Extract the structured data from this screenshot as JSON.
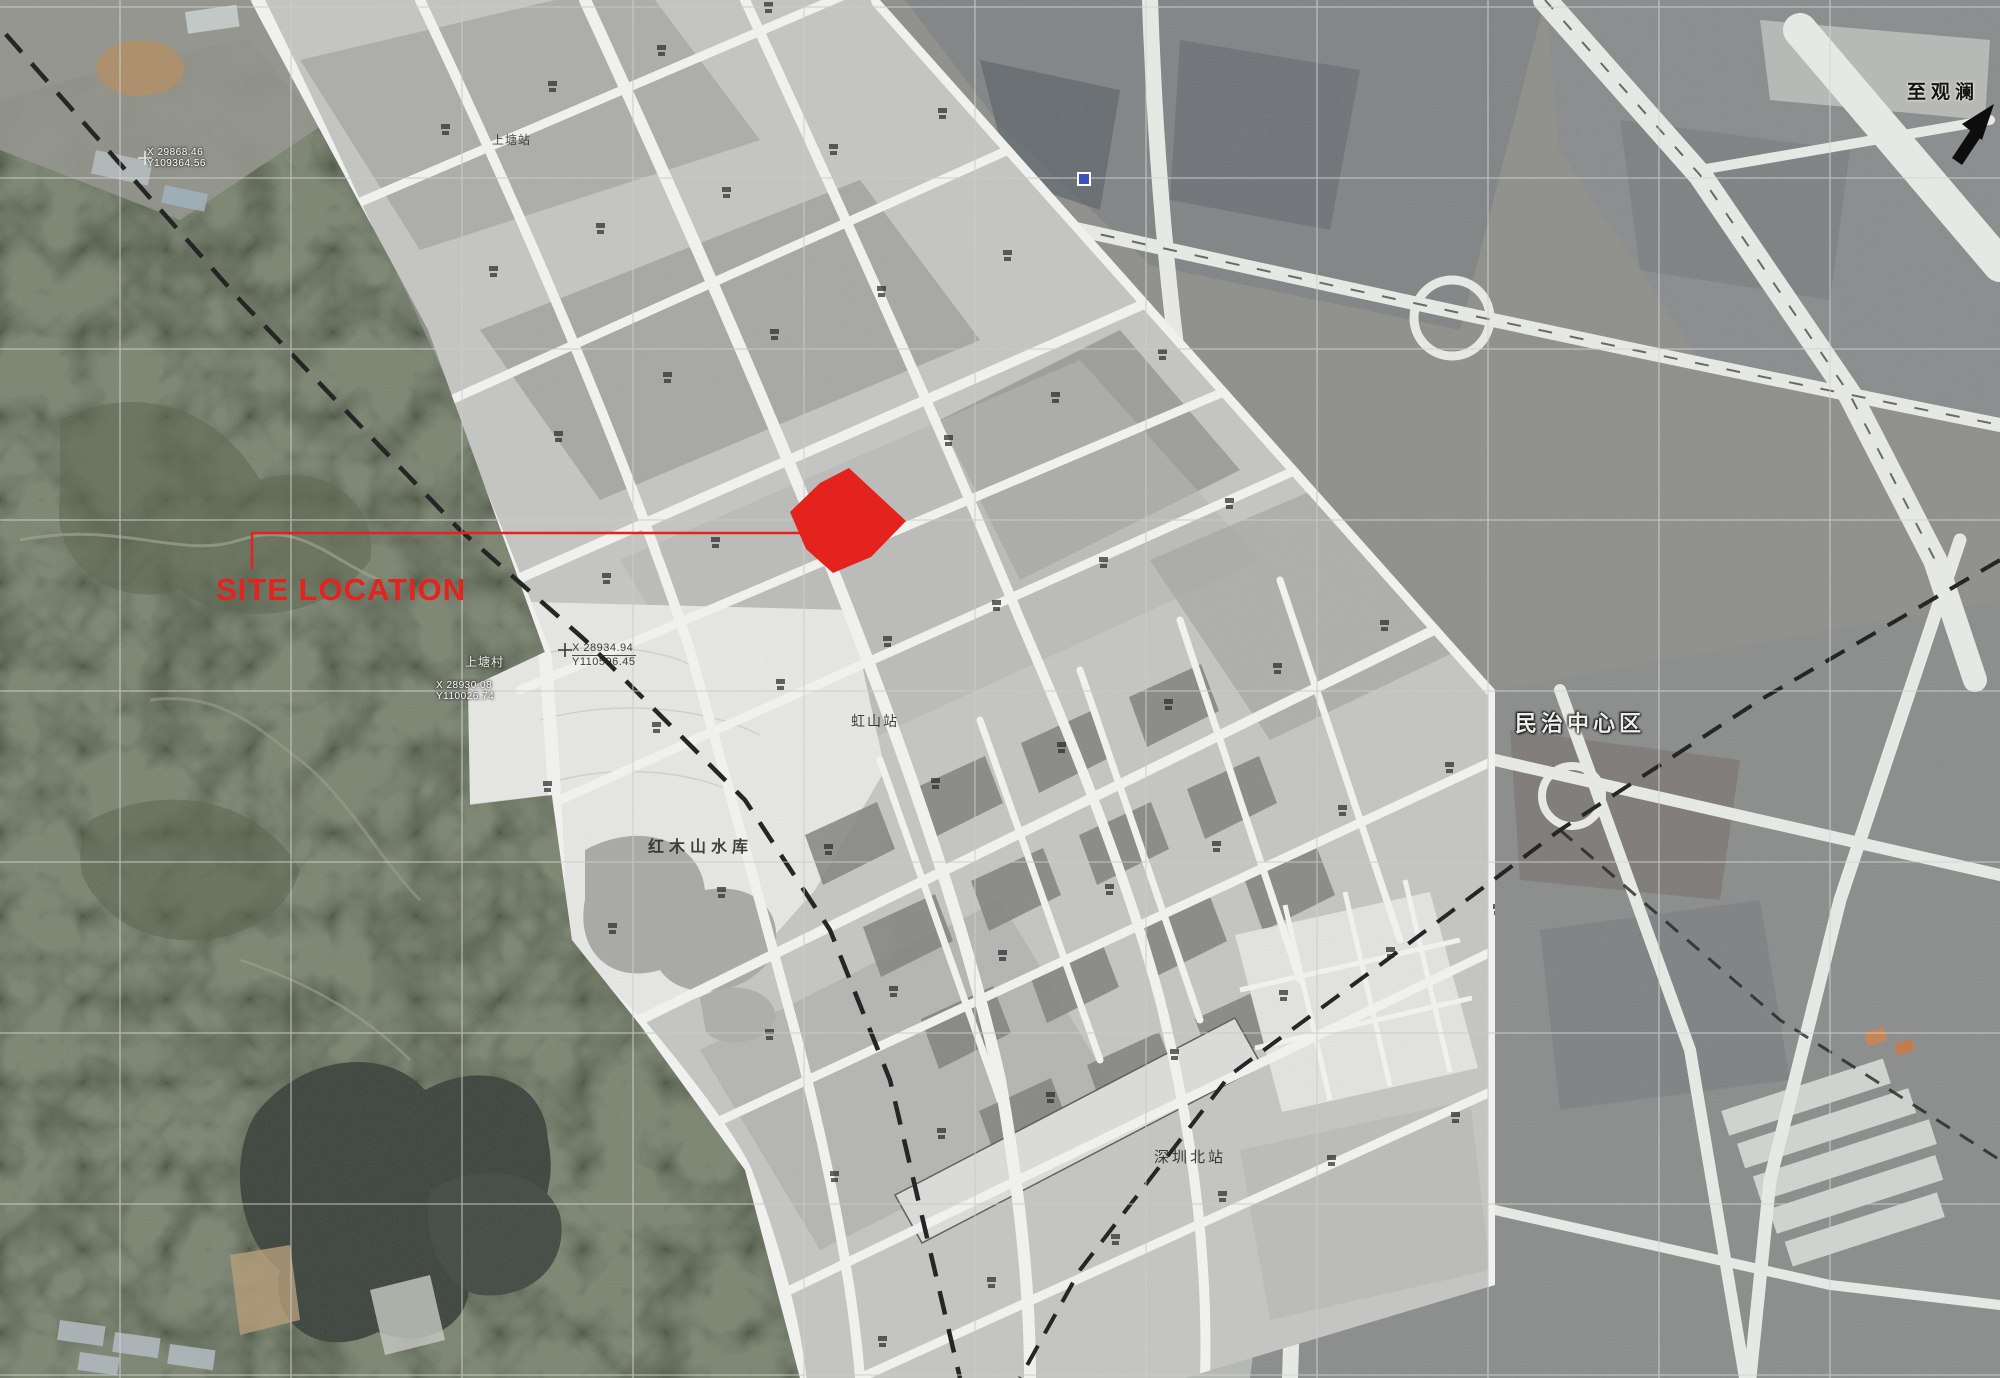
{
  "map": {
    "site_label": "SITE LOCATION",
    "labels": {
      "shangtang_station": "上塘站",
      "shangtang_village": "上塘村",
      "hongshan_station": "虹山站",
      "hongmushan_reservoir": "红木山水库",
      "shenzhen_north_station": "深圳北站",
      "minzhi_center": "民治中心区",
      "to_guanlan": "至观澜"
    },
    "survey_points": [
      {
        "x": "X 29868.46",
        "y": "Y109364.56"
      },
      {
        "x": "X 28930.08",
        "y": "Y110026.74"
      },
      {
        "x": "X 28934.94",
        "y": "Y110596.45"
      }
    ],
    "colors": {
      "site_red": "#e5231e",
      "forest_green": "#47503d",
      "water_dark": "#343c35",
      "urban_gray": "#8b8c88",
      "plan_gray": "#c5c5c3",
      "road_white": "#f7f7f5",
      "rail_black": "#121212",
      "grid_gray": "#d8d8d8",
      "marker_blue": "#3c52bd"
    }
  }
}
